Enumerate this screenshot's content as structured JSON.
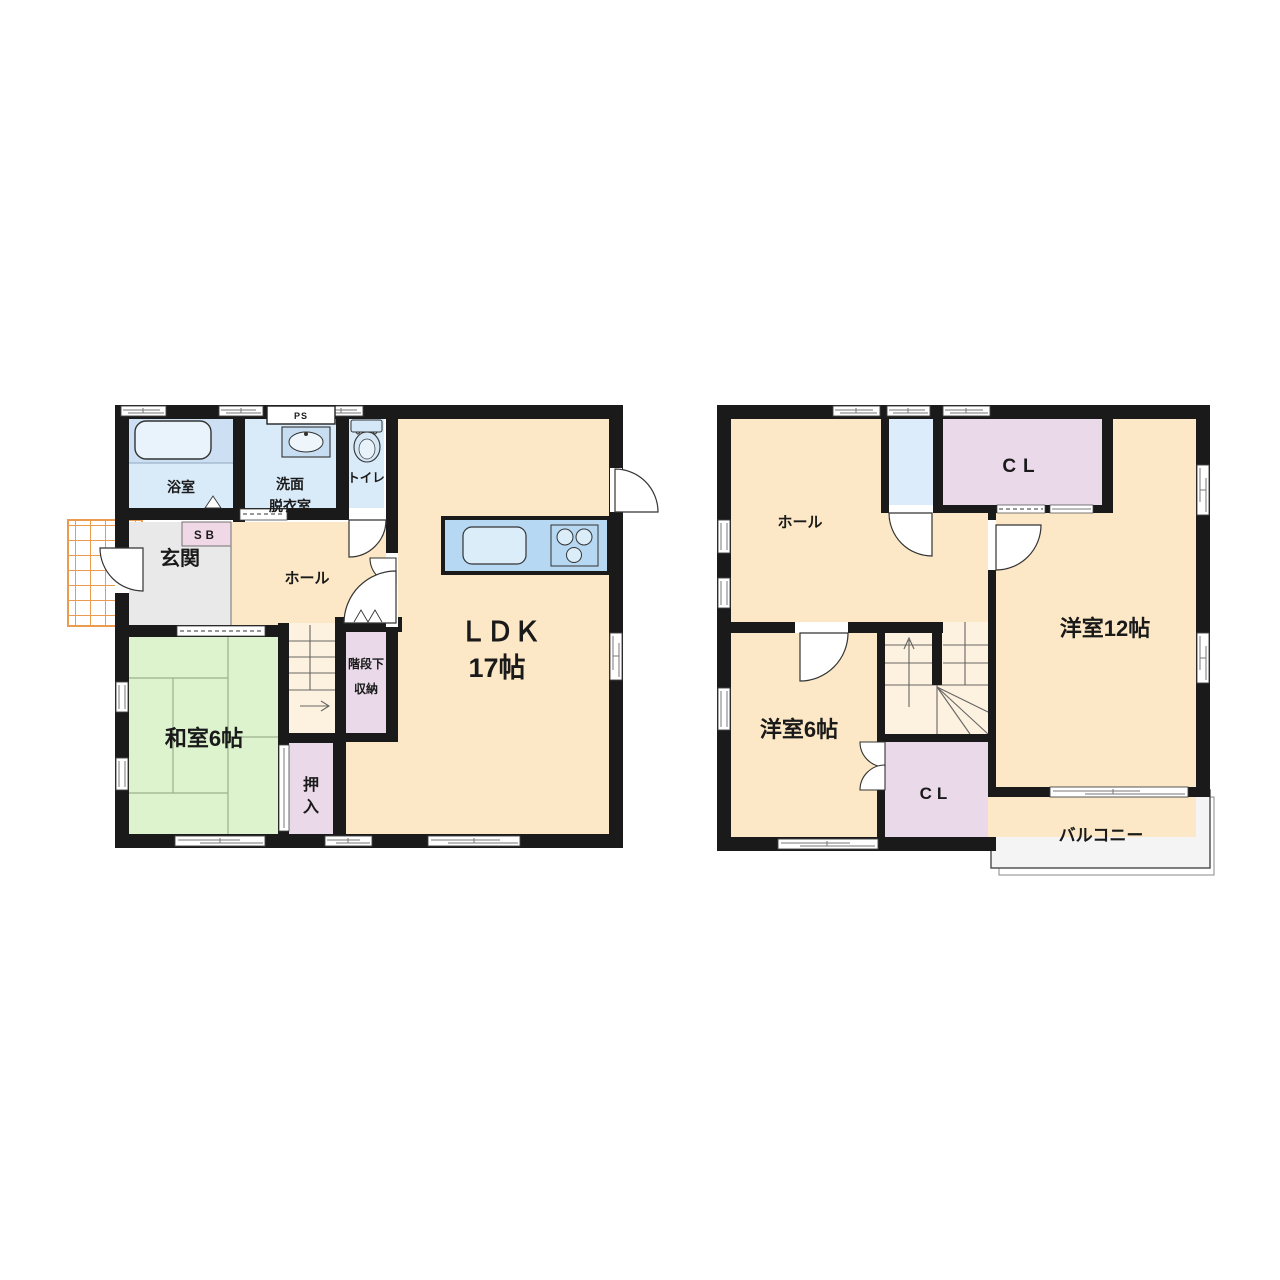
{
  "floor1": {
    "bath": "浴室",
    "washroom_l1": "洗面",
    "washroom_l2": "脱衣室",
    "toilet": "トイレ",
    "ps": "PS",
    "shoe_box": "SB",
    "entrance": "玄関",
    "hall": "ホール",
    "ldk_l1": "ＬＤＫ",
    "ldk_l2": "17帖",
    "understair_l1": "階段下",
    "understair_l2": "収納",
    "japanese_room": "和室6帖",
    "oshiire_l1": "押",
    "oshiire_l2": "入"
  },
  "floor2": {
    "hall": "ホール",
    "closet_top": "CL",
    "western_room_12": "洋室12帖",
    "western_room_6": "洋室6帖",
    "closet_bottom": "CL",
    "balcony": "バルコニー"
  },
  "colors": {
    "wall": "#1a1a1a",
    "room_cream": "#fce8c6",
    "stair_light": "#fdf1df",
    "room_blue": "#d9eaf8",
    "room_green": "#dcf3ce",
    "closet_lavender": "#ead9e9",
    "entrance_gray": "#e9e9e9",
    "balcony_gray": "#f4f4f5",
    "tile_orange": "#eb9b4f",
    "fixture_blue": "#b7d8f2",
    "shoebox_pink": "#f0d8e6"
  }
}
